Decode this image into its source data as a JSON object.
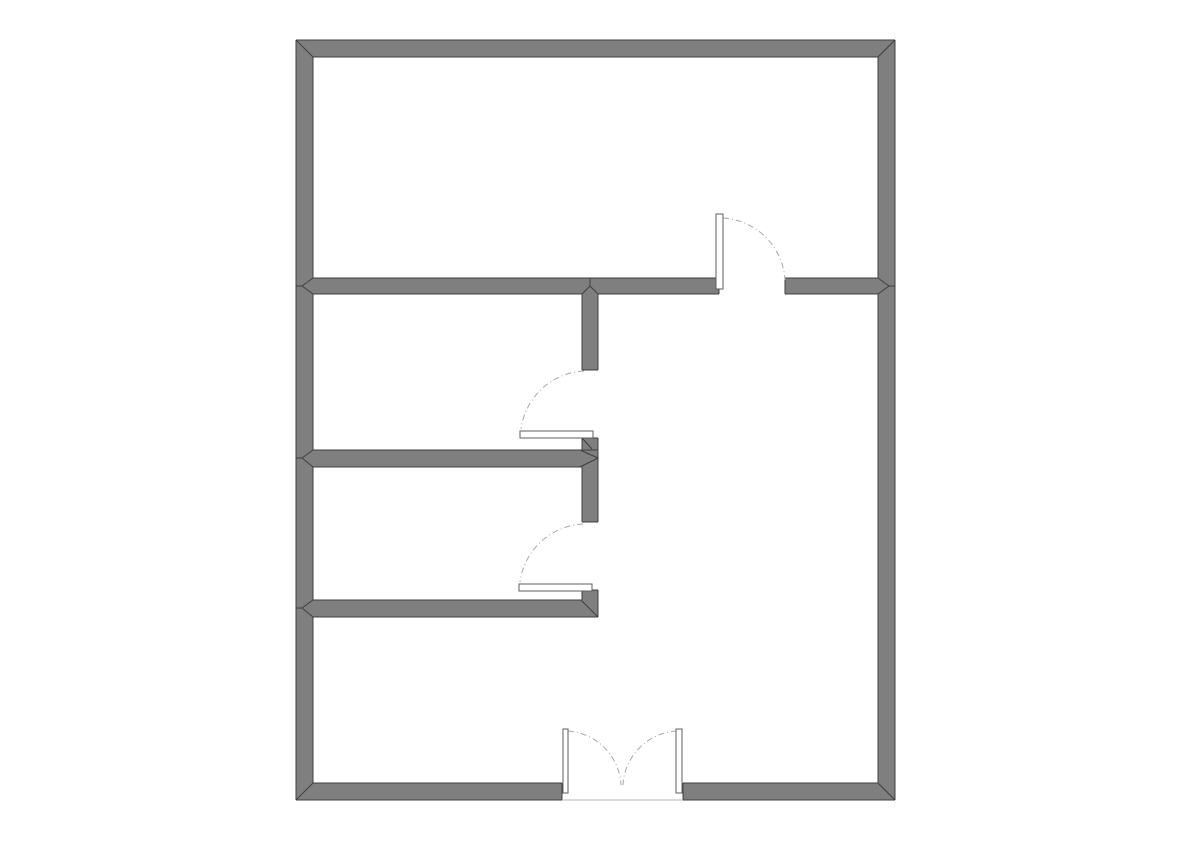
{
  "colors": {
    "background": "#ffffff",
    "wall_fill": "#7f7f7f",
    "wall_outline": "#3f3f3f",
    "joint_seam": "#3f3f3f",
    "door_leaf_fill": "#ffffff",
    "door_leaf_outline": "#5f5f5f",
    "swing_arc": "#a8a8a8",
    "threshold_line": "#b5b5b5"
  },
  "floor_plan": {
    "canvas": {
      "width": 1191,
      "height": 842
    },
    "outer_wall_thickness": 17,
    "interior_wall_thickness": 16,
    "walls": [
      {
        "name": "outer-wall-top",
        "x": 296,
        "y": 40,
        "w": 599,
        "h": 17
      },
      {
        "name": "outer-wall-left",
        "x": 296,
        "y": 40,
        "w": 17,
        "h": 760
      },
      {
        "name": "outer-wall-right",
        "x": 878,
        "y": 40,
        "w": 17,
        "h": 760
      },
      {
        "name": "outer-wall-bottom-left",
        "x": 296,
        "y": 783,
        "w": 266,
        "h": 17
      },
      {
        "name": "outer-wall-bottom-right",
        "x": 683,
        "y": 783,
        "w": 212,
        "h": 17
      },
      {
        "name": "interior-wall-h1-left",
        "x": 313,
        "y": 278,
        "w": 406,
        "h": 16
      },
      {
        "name": "interior-wall-h1-right",
        "x": 785,
        "y": 278,
        "w": 93,
        "h": 16
      },
      {
        "name": "interior-wall-v-upper",
        "x": 582,
        "y": 294,
        "w": 16,
        "h": 76
      },
      {
        "name": "interior-wall-h2",
        "x": 313,
        "y": 450,
        "w": 285,
        "h": 17
      },
      {
        "name": "interior-wall-h2-stub",
        "x": 582,
        "y": 438,
        "w": 16,
        "h": 13
      },
      {
        "name": "interior-wall-v-lower",
        "x": 582,
        "y": 467,
        "w": 16,
        "h": 55
      },
      {
        "name": "interior-wall-h3",
        "x": 313,
        "y": 600,
        "w": 285,
        "h": 17
      },
      {
        "name": "interior-wall-h3-stub",
        "x": 582,
        "y": 590,
        "w": 16,
        "h": 11
      }
    ],
    "outline_segments": [
      [
        296,
        40,
        895,
        40
      ],
      [
        296,
        40,
        296,
        800
      ],
      [
        895,
        40,
        895,
        800
      ],
      [
        296,
        800,
        562,
        800
      ],
      [
        683,
        800,
        895,
        800
      ],
      [
        313,
        57,
        878,
        57
      ],
      [
        313,
        57,
        313,
        278
      ],
      [
        313,
        294,
        313,
        450
      ],
      [
        313,
        467,
        313,
        600
      ],
      [
        313,
        617,
        313,
        783
      ],
      [
        878,
        57,
        878,
        278
      ],
      [
        878,
        294,
        878,
        783
      ],
      [
        313,
        783,
        562,
        783
      ],
      [
        683,
        783,
        878,
        783
      ],
      [
        562,
        783,
        562,
        800
      ],
      [
        683,
        783,
        683,
        800
      ],
      [
        313,
        278,
        719,
        278
      ],
      [
        313,
        294,
        582,
        294
      ],
      [
        598,
        294,
        719,
        294
      ],
      [
        719,
        278,
        719,
        294
      ],
      [
        785,
        278,
        878,
        278
      ],
      [
        785,
        294,
        878,
        294
      ],
      [
        785,
        278,
        785,
        294
      ],
      [
        582,
        294,
        582,
        370
      ],
      [
        598,
        294,
        598,
        370
      ],
      [
        582,
        370,
        598,
        370
      ],
      [
        313,
        450,
        598,
        450
      ],
      [
        313,
        467,
        582,
        467
      ],
      [
        582,
        438,
        582,
        450
      ],
      [
        582,
        438,
        598,
        438
      ],
      [
        598,
        438,
        598,
        467
      ],
      [
        582,
        467,
        582,
        522
      ],
      [
        598,
        467,
        598,
        522
      ],
      [
        582,
        522,
        598,
        522
      ],
      [
        313,
        600,
        582,
        600
      ],
      [
        313,
        617,
        598,
        617
      ],
      [
        582,
        590,
        582,
        600
      ],
      [
        582,
        590,
        598,
        590
      ],
      [
        598,
        590,
        598,
        617
      ]
    ],
    "joint_seams": [
      [
        296,
        40,
        313,
        57
      ],
      [
        895,
        40,
        878,
        57
      ],
      [
        296,
        800,
        313,
        783
      ],
      [
        895,
        800,
        878,
        783
      ],
      [
        296,
        286,
        302,
        286
      ],
      [
        302,
        286,
        313,
        278
      ],
      [
        302,
        286,
        313,
        294
      ],
      [
        895,
        286,
        889,
        286
      ],
      [
        889,
        286,
        878,
        278
      ],
      [
        889,
        286,
        878,
        294
      ],
      [
        296,
        458,
        302,
        458
      ],
      [
        302,
        458,
        313,
        450
      ],
      [
        302,
        458,
        313,
        467
      ],
      [
        296,
        608,
        302,
        608
      ],
      [
        302,
        608,
        313,
        600
      ],
      [
        302,
        608,
        313,
        617
      ],
      [
        590,
        278,
        590,
        286
      ],
      [
        590,
        286,
        582,
        294
      ],
      [
        590,
        286,
        598,
        294
      ],
      [
        580,
        450,
        598,
        458
      ],
      [
        580,
        467,
        598,
        458
      ],
      [
        582,
        438,
        592,
        449
      ],
      [
        581,
        600,
        598,
        617
      ]
    ],
    "door_leaves": [
      {
        "name": "door-1-leaf",
        "x": 716,
        "y": 214,
        "w": 7,
        "h": 75
      },
      {
        "name": "door-2-leaf",
        "x": 520,
        "y": 431,
        "w": 73,
        "h": 7
      },
      {
        "name": "door-3-leaf",
        "x": 519,
        "y": 584,
        "w": 73,
        "h": 7
      },
      {
        "name": "entry-door-left-leaf",
        "x": 563,
        "y": 729,
        "w": 5,
        "h": 64
      },
      {
        "name": "entry-door-right-leaf",
        "x": 676,
        "y": 729,
        "w": 6,
        "h": 64
      }
    ],
    "swing_arcs": [
      {
        "name": "door-1-swing-arc",
        "d": "M 723 218 A 66 66 0 0 1 785 280"
      },
      {
        "name": "door-2-swing-arc",
        "d": "M 584 371 A 67 67 0 0 0 521 429"
      },
      {
        "name": "door-3-swing-arc",
        "d": "M 583 524 A 67 67 0 0 0 520 582"
      },
      {
        "name": "entry-door-left-swing-arc",
        "d": "M 568 731 A 57 57 0 0 1 621 785"
      },
      {
        "name": "entry-door-right-swing-arc",
        "d": "M 677 731 A 57 57 0 0 0 623 785"
      }
    ],
    "threshold": {
      "name": "entry-threshold-line",
      "x1": 562,
      "y1": 800,
      "x2": 683,
      "y2": 800
    }
  }
}
